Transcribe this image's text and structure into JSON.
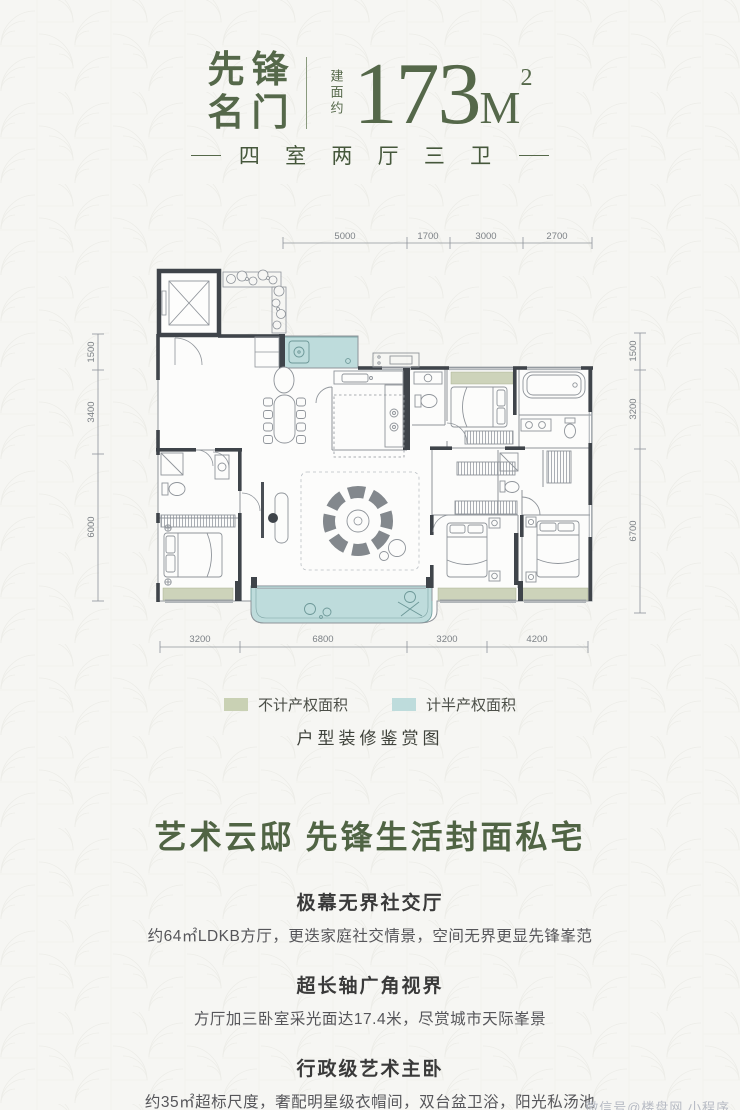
{
  "header": {
    "brand_line1": "先锋",
    "brand_line2": "名门",
    "area_prefix": "建面约",
    "area_value": "173",
    "area_unit": "M",
    "area_sup": "2",
    "subtitle": "四 室 两 厅 三 卫"
  },
  "floorplan": {
    "dimensions": {
      "top": [
        "5000",
        "1700",
        "3000",
        "2700"
      ],
      "left": [
        "1500",
        "3400",
        "6000"
      ],
      "right": [
        "1500",
        "3200",
        "6700"
      ],
      "bottom": [
        "3200",
        "6800",
        "3200",
        "4200"
      ]
    },
    "legend": [
      {
        "label": "不计产权面积",
        "color": "#c9d1b4"
      },
      {
        "label": "计半产权面积",
        "color": "#bedcdc"
      }
    ],
    "caption": "户型装修鉴赏图"
  },
  "main_title": "艺术云邸  先锋生活封面私宅",
  "sections": [
    {
      "heading": "极幕无界社交厅",
      "body": "约64㎡LDKB方厅，更迭家庭社交情景，空间无界更显先锋峯范"
    },
    {
      "heading": "超长轴广角视界",
      "body": "方厅加三卧室采光面达17.4米，尽赏城市天际峯景"
    },
    {
      "heading": "行政级艺术主卧",
      "body": "约35㎡超标尺度，奢配明星级衣帽间，双台盆卫浴，阳光私汤池"
    }
  ],
  "watermark": "微信号@楼盘网 小程序",
  "colors": {
    "brand_green": "#55684a",
    "sage": "#c9d1b4",
    "teal": "#bedcdc",
    "wall": "#3f444a",
    "heading_text": "#3a3a3a",
    "body_text": "#56565a"
  }
}
